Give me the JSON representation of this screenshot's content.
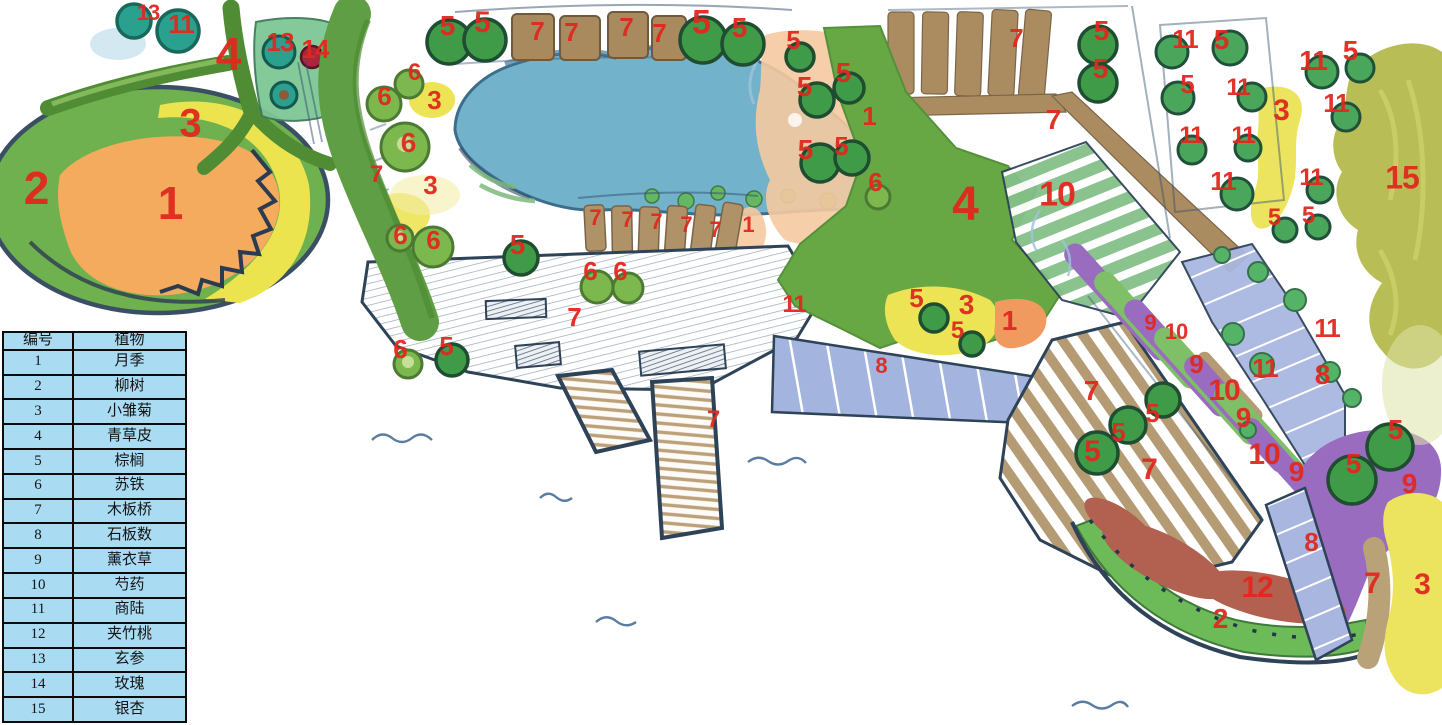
{
  "title": "hand-drawn garden planting plan",
  "legend": {
    "headers": [
      "编号",
      "植物"
    ],
    "rows": [
      [
        "1",
        "月季"
      ],
      [
        "2",
        "柳树"
      ],
      [
        "3",
        "小雏菊"
      ],
      [
        "4",
        "青草皮"
      ],
      [
        "5",
        "棕榈"
      ],
      [
        "6",
        "苏铁"
      ],
      [
        "7",
        "木板桥"
      ],
      [
        "8",
        "石板数"
      ],
      [
        "9",
        "薰衣草"
      ],
      [
        "10",
        "芍药"
      ],
      [
        "11",
        "商陆"
      ],
      [
        "12",
        "夹竹桃"
      ],
      [
        "13",
        "玄参"
      ],
      [
        "14",
        "玫瑰"
      ],
      [
        "15",
        "银杏"
      ]
    ]
  },
  "map_labels": [
    {
      "n": "13",
      "x": 148,
      "y": 14,
      "s": 22
    },
    {
      "n": "11",
      "x": 181,
      "y": 25,
      "s": 26
    },
    {
      "n": "4",
      "x": 228,
      "y": 56,
      "s": 46
    },
    {
      "n": "13",
      "x": 280,
      "y": 43,
      "s": 26
    },
    {
      "n": "14",
      "x": 315,
      "y": 50,
      "s": 26
    },
    {
      "n": "2",
      "x": 36,
      "y": 190,
      "s": 46
    },
    {
      "n": "3",
      "x": 190,
      "y": 125,
      "s": 40
    },
    {
      "n": "1",
      "x": 170,
      "y": 205,
      "s": 46
    },
    {
      "n": "5",
      "x": 447,
      "y": 27,
      "s": 28
    },
    {
      "n": "5",
      "x": 482,
      "y": 24,
      "s": 30
    },
    {
      "n": "7",
      "x": 537,
      "y": 32,
      "s": 26
    },
    {
      "n": "7",
      "x": 571,
      "y": 33,
      "s": 26
    },
    {
      "n": "7",
      "x": 626,
      "y": 28,
      "s": 26
    },
    {
      "n": "7",
      "x": 659,
      "y": 34,
      "s": 26
    },
    {
      "n": "5",
      "x": 701,
      "y": 24,
      "s": 34
    },
    {
      "n": "5",
      "x": 739,
      "y": 29,
      "s": 28
    },
    {
      "n": "6",
      "x": 414,
      "y": 74,
      "s": 24
    },
    {
      "n": "6",
      "x": 384,
      "y": 97,
      "s": 26
    },
    {
      "n": "3",
      "x": 434,
      "y": 101,
      "s": 26
    },
    {
      "n": "6",
      "x": 408,
      "y": 144,
      "s": 28
    },
    {
      "n": "7",
      "x": 376,
      "y": 176,
      "s": 24
    },
    {
      "n": "3",
      "x": 430,
      "y": 186,
      "s": 26
    },
    {
      "n": "6",
      "x": 400,
      "y": 236,
      "s": 26
    },
    {
      "n": "6",
      "x": 433,
      "y": 241,
      "s": 26
    },
    {
      "n": "5",
      "x": 517,
      "y": 246,
      "s": 28
    },
    {
      "n": "7",
      "x": 595,
      "y": 219,
      "s": 22
    },
    {
      "n": "7",
      "x": 627,
      "y": 221,
      "s": 22
    },
    {
      "n": "7",
      "x": 656,
      "y": 223,
      "s": 22
    },
    {
      "n": "7",
      "x": 686,
      "y": 226,
      "s": 22
    },
    {
      "n": "7",
      "x": 715,
      "y": 231,
      "s": 22
    },
    {
      "n": "1",
      "x": 748,
      "y": 226,
      "s": 22
    },
    {
      "n": "5",
      "x": 793,
      "y": 41,
      "s": 26
    },
    {
      "n": "5",
      "x": 804,
      "y": 88,
      "s": 28
    },
    {
      "n": "5",
      "x": 843,
      "y": 74,
      "s": 28
    },
    {
      "n": "1",
      "x": 869,
      "y": 117,
      "s": 26
    },
    {
      "n": "5",
      "x": 805,
      "y": 151,
      "s": 28
    },
    {
      "n": "5",
      "x": 841,
      "y": 147,
      "s": 26
    },
    {
      "n": "6",
      "x": 875,
      "y": 183,
      "s": 26
    },
    {
      "n": "7",
      "x": 1016,
      "y": 39,
      "s": 26
    },
    {
      "n": "5",
      "x": 1101,
      "y": 32,
      "s": 28
    },
    {
      "n": "5",
      "x": 1100,
      "y": 70,
      "s": 28
    },
    {
      "n": "7",
      "x": 1053,
      "y": 121,
      "s": 28
    },
    {
      "n": "4",
      "x": 965,
      "y": 207,
      "s": 48
    },
    {
      "n": "10",
      "x": 1057,
      "y": 196,
      "s": 34
    },
    {
      "n": "11",
      "x": 1185,
      "y": 40,
      "s": 26
    },
    {
      "n": "5",
      "x": 1221,
      "y": 41,
      "s": 28
    },
    {
      "n": "5",
      "x": 1187,
      "y": 85,
      "s": 26
    },
    {
      "n": "11",
      "x": 1238,
      "y": 89,
      "s": 24
    },
    {
      "n": "11",
      "x": 1313,
      "y": 62,
      "s": 28
    },
    {
      "n": "5",
      "x": 1350,
      "y": 52,
      "s": 28
    },
    {
      "n": "3",
      "x": 1281,
      "y": 112,
      "s": 30
    },
    {
      "n": "11",
      "x": 1336,
      "y": 104,
      "s": 26
    },
    {
      "n": "11",
      "x": 1191,
      "y": 137,
      "s": 24
    },
    {
      "n": "11",
      "x": 1243,
      "y": 137,
      "s": 24
    },
    {
      "n": "11",
      "x": 1223,
      "y": 182,
      "s": 26
    },
    {
      "n": "15",
      "x": 1402,
      "y": 179,
      "s": 32
    },
    {
      "n": "11",
      "x": 1311,
      "y": 179,
      "s": 24
    },
    {
      "n": "5",
      "x": 1274,
      "y": 219,
      "s": 24
    },
    {
      "n": "5",
      "x": 1308,
      "y": 217,
      "s": 24
    },
    {
      "n": "6",
      "x": 590,
      "y": 272,
      "s": 26
    },
    {
      "n": "6",
      "x": 620,
      "y": 272,
      "s": 26
    },
    {
      "n": "7",
      "x": 574,
      "y": 318,
      "s": 26
    },
    {
      "n": "6",
      "x": 400,
      "y": 350,
      "s": 26
    },
    {
      "n": "5",
      "x": 446,
      "y": 347,
      "s": 26
    },
    {
      "n": "11",
      "x": 794,
      "y": 306,
      "s": 24
    },
    {
      "n": "7",
      "x": 713,
      "y": 421,
      "s": 24
    },
    {
      "n": "5",
      "x": 916,
      "y": 299,
      "s": 26
    },
    {
      "n": "3",
      "x": 966,
      "y": 306,
      "s": 28
    },
    {
      "n": "5",
      "x": 957,
      "y": 332,
      "s": 24
    },
    {
      "n": "1",
      "x": 1009,
      "y": 322,
      "s": 28
    },
    {
      "n": "8",
      "x": 881,
      "y": 367,
      "s": 22
    },
    {
      "n": "9",
      "x": 1150,
      "y": 324,
      "s": 22
    },
    {
      "n": "10",
      "x": 1176,
      "y": 333,
      "s": 22
    },
    {
      "n": "9",
      "x": 1196,
      "y": 365,
      "s": 26
    },
    {
      "n": "10",
      "x": 1224,
      "y": 392,
      "s": 30
    },
    {
      "n": "11",
      "x": 1265,
      "y": 369,
      "s": 26
    },
    {
      "n": "9",
      "x": 1243,
      "y": 419,
      "s": 28
    },
    {
      "n": "11",
      "x": 1327,
      "y": 329,
      "s": 26
    },
    {
      "n": "8",
      "x": 1322,
      "y": 376,
      "s": 28
    },
    {
      "n": "10",
      "x": 1264,
      "y": 456,
      "s": 30
    },
    {
      "n": "9",
      "x": 1296,
      "y": 473,
      "s": 28
    },
    {
      "n": "7",
      "x": 1091,
      "y": 392,
      "s": 28
    },
    {
      "n": "5",
      "x": 1152,
      "y": 414,
      "s": 26
    },
    {
      "n": "5",
      "x": 1118,
      "y": 433,
      "s": 26
    },
    {
      "n": "5",
      "x": 1092,
      "y": 453,
      "s": 30
    },
    {
      "n": "7",
      "x": 1149,
      "y": 471,
      "s": 30
    },
    {
      "n": "5",
      "x": 1395,
      "y": 431,
      "s": 28
    },
    {
      "n": "5",
      "x": 1353,
      "y": 465,
      "s": 28
    },
    {
      "n": "9",
      "x": 1409,
      "y": 485,
      "s": 28
    },
    {
      "n": "8",
      "x": 1311,
      "y": 543,
      "s": 26
    },
    {
      "n": "12",
      "x": 1257,
      "y": 589,
      "s": 30
    },
    {
      "n": "2",
      "x": 1220,
      "y": 620,
      "s": 28
    },
    {
      "n": "7",
      "x": 1372,
      "y": 585,
      "s": 30
    },
    {
      "n": "3",
      "x": 1422,
      "y": 586,
      "s": 30
    }
  ],
  "colors": {
    "label_red": "#e0291f",
    "table_bg": "#a9dbf2",
    "table_border": "#0b0b0b",
    "pond_blue": "#72b2cb",
    "lawn_green": "#67a845",
    "path_green_dark": "#4f8c33",
    "palm_tree_green": "#3f9b47",
    "cycad_green": "#7db84f",
    "figwort_teal": "#2aa08e",
    "daisy_yellow": "#ece454",
    "rose_orange": "#f2a95c",
    "rose_peach": "#f5c9a0",
    "wood_tan": "#ab8c60",
    "stone_blue": "#a3b4de",
    "lavender_purple": "#9a6cc0",
    "oleander_red": "#b2604f",
    "willow_green": "#6cbb58",
    "ginkgo_olive": "#b9bd55",
    "sketch_navy": "#2e4258"
  }
}
